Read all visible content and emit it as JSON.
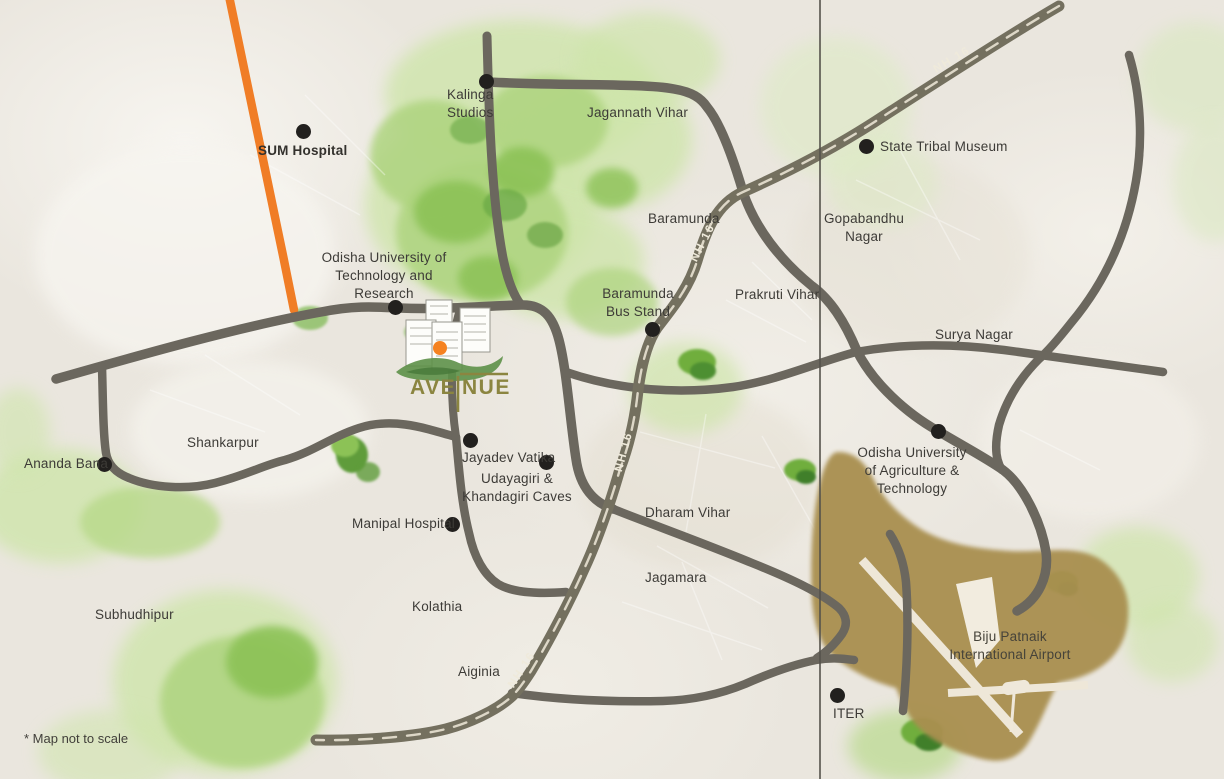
{
  "brand": {
    "name": "AVENUE",
    "text_left": "AVE",
    "text_right": "NUE"
  },
  "highway": {
    "label": "NH 16"
  },
  "disclaimer": "* Map not to scale",
  "airport": {
    "label": "Biju Patnaik\nInternational Airport"
  },
  "places": [
    {
      "id": "sum-hospital",
      "label": "SUM Hospital"
    },
    {
      "id": "kalinga-studios",
      "label": "Kalinga\nStudios"
    },
    {
      "id": "jagannath-vihar",
      "label": "Jagannath Vihar"
    },
    {
      "id": "state-tribal-museum",
      "label": "State Tribal Museum"
    },
    {
      "id": "baramunda",
      "label": "Baramunda"
    },
    {
      "id": "gopabandhu-nagar",
      "label": "Gopabandhu\nNagar"
    },
    {
      "id": "outr",
      "label": "Odisha University of\nTechnology and\nResearch"
    },
    {
      "id": "baramunda-bus-stand",
      "label": "Baramunda\nBus Stand"
    },
    {
      "id": "prakruti-vihar",
      "label": "Prakruti Vihar"
    },
    {
      "id": "surya-nagar",
      "label": "Surya Nagar"
    },
    {
      "id": "shankarpur",
      "label": "Shankarpur"
    },
    {
      "id": "ananda-bana",
      "label": "Ananda Bana"
    },
    {
      "id": "jayadev-vatika",
      "label": "Jayadev Vatika"
    },
    {
      "id": "udayagiri-khandagiri-caves",
      "label": "Udayagiri &\nKhandagiri Caves"
    },
    {
      "id": "manipal-hospital",
      "label": "Manipal Hospital"
    },
    {
      "id": "ouat",
      "label": "Odisha University\nof Agriculture &\nTechnology"
    },
    {
      "id": "dharam-vihar",
      "label": "Dharam Vihar"
    },
    {
      "id": "jagamara",
      "label": "Jagamara"
    },
    {
      "id": "kolathia",
      "label": "Kolathia"
    },
    {
      "id": "aiginia",
      "label": "Aiginia"
    },
    {
      "id": "subhudhipur",
      "label": "Subhudhipur"
    },
    {
      "id": "iter",
      "label": "ITER"
    }
  ],
  "colors": {
    "road": "#6b675e",
    "highway_road": "#74705f",
    "highway_dash": "#ddd7c7",
    "orange_road": "#f07d26",
    "map_green": "#aed47f",
    "airport_brown": "#a98f4f",
    "logo_olive": "#8b8540",
    "logo_orange": "#f58220",
    "marker_dot": "#22201e",
    "label_text": "#3d3b37"
  }
}
